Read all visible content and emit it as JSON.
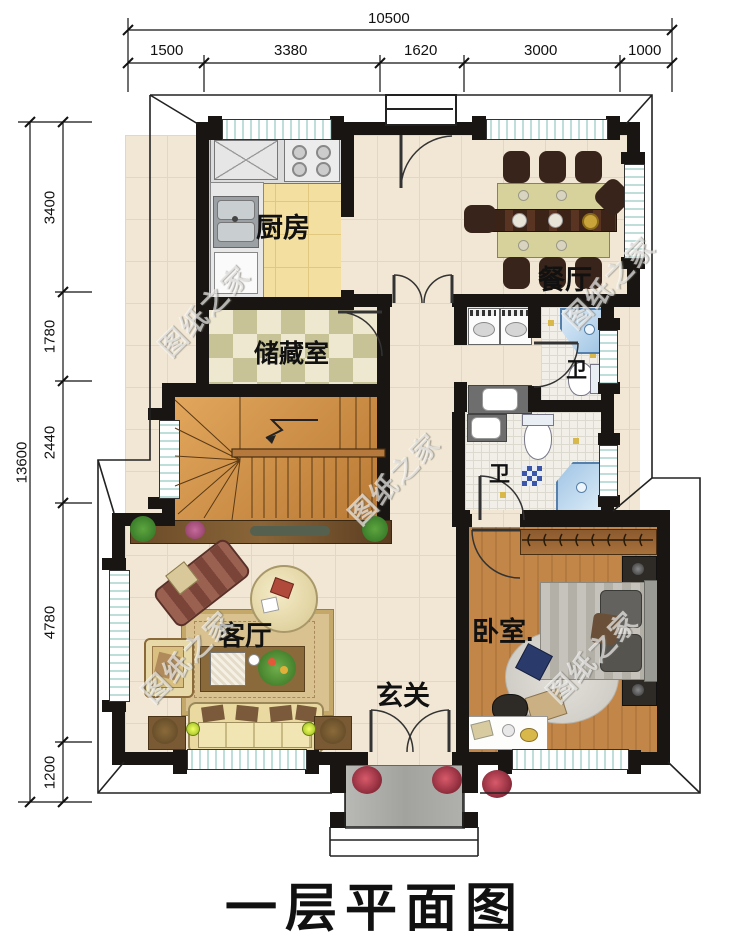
{
  "title": "一层平面图",
  "watermark": "图纸之家",
  "dimensions": {
    "top": {
      "total": "10500",
      "segments": [
        "1500",
        "3380",
        "1620",
        "3000",
        "1000"
      ]
    },
    "left": {
      "total": "13600",
      "segments": [
        "3400",
        "1780",
        "2440",
        "4780",
        "1200"
      ]
    }
  },
  "rooms": {
    "kitchen": "厨房",
    "dining": "餐厅",
    "storage": "储藏室",
    "bath_upper": "卫",
    "bath_lower": "卫",
    "living": "客厅",
    "foyer": "玄关",
    "bedroom": "卧室."
  }
}
